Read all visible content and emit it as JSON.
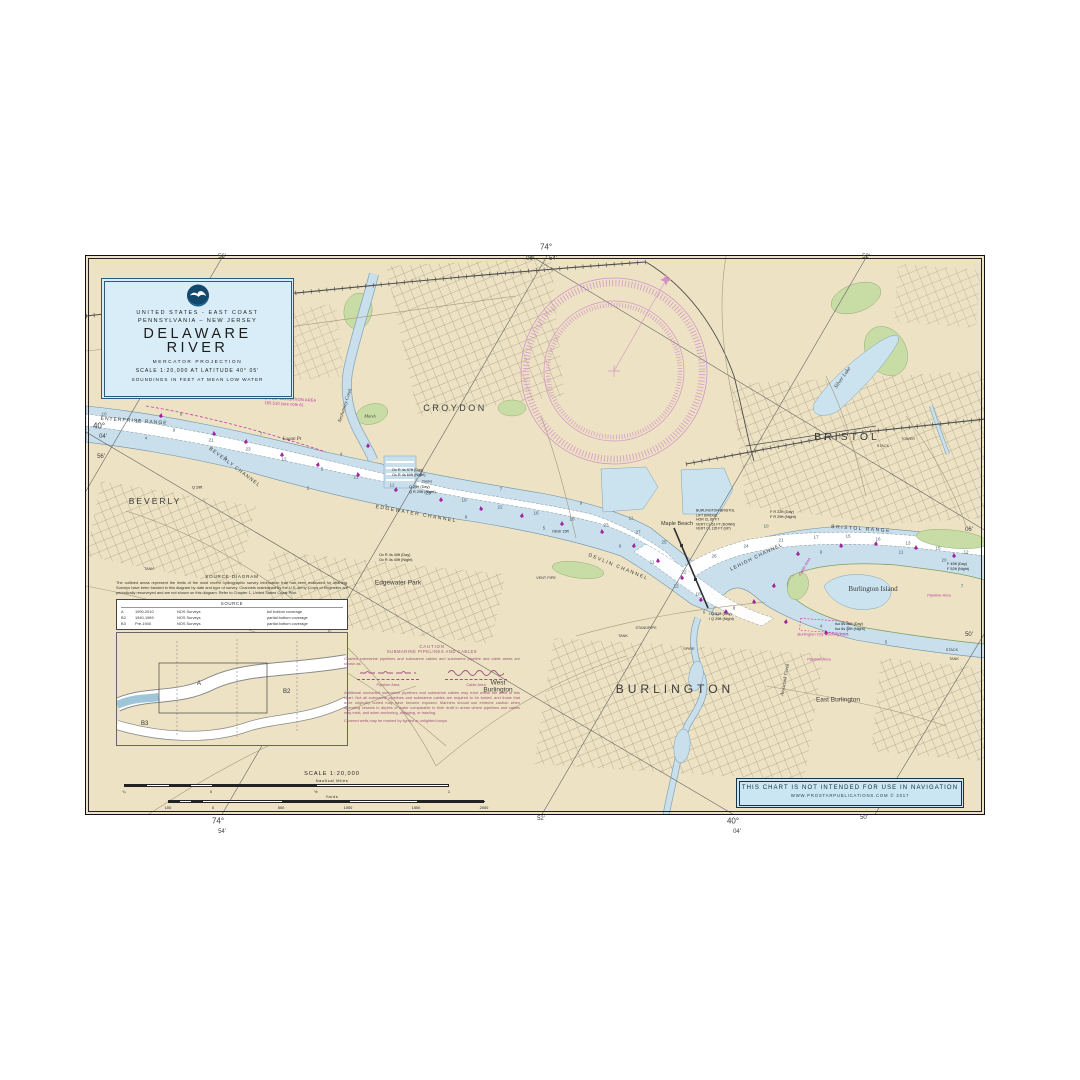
{
  "title_block": {
    "line1": "UNITED STATES - EAST COAST",
    "line2": "PENNSYLVANIA – NEW JERSEY",
    "title1": "DELAWARE",
    "title2": "RIVER",
    "line3": "MERCATOR PROJECTION",
    "line4": "SCALE 1:20,000 AT LATITUDE 40° 05'",
    "line5": "SOUNDINGS IN FEET AT MEAN LOW WATER"
  },
  "disclaimer": {
    "line1": "THIS CHART IS NOT INTENDED FOR USE IN NAVIGATION",
    "line2": "WWW.PROSTARPUBLICATIONS.COM   © 2017"
  },
  "source_diagram": {
    "heading": "SOURCE DIAGRAM",
    "body": "The outlined areas represent the limits of the most recent hydrographic survey information that has been evaluated for charting.  Surveys have been banded in this diagram by date and type of survey.  Channels maintained by the U.S. Army Corps of Engineers are periodically resurveyed and are not shown on this diagram.  Refer to Chapter 1, United States Coast Pilot.",
    "table_title": "SOURCE",
    "rows": [
      {
        "code": "A",
        "years": "1990-2010",
        "org": "NOS Surveys",
        "coverage": "full bottom coverage"
      },
      {
        "code": "B2",
        "years": "1940-1989",
        "org": "NOS Surveys",
        "coverage": "partial bottom coverage"
      },
      {
        "code": "B3",
        "years": "Pre-1940",
        "org": "NOS Surveys",
        "coverage": "partial bottom coverage"
      }
    ]
  },
  "caution": {
    "title": "CAUTION",
    "subtitle": "SUBMARINE PIPELINES AND CABLES",
    "para1": "Charted submarine pipelines and submarine cables and submarine pipeline and cable areas are shown as:",
    "pipeline_label": "Pipeline Area",
    "cable_label": "Cable Area",
    "para2": "Additional uncharted submarine pipelines and submarine cables may exist within the area of this chart.  Not all submarine pipelines and submarine cables are required to be buried, and those that were originally buried may have become exposed.  Mariners should use extreme caution when operating vessels in depths of water comparable to their draft in areas where pipelines and cables may exist, and when anchoring, dragging, or trawling.",
    "para3": "Covered wells may be marked by lighted or unlighted buoys."
  },
  "scalebar": {
    "title": "SCALE 1:20,000",
    "nm_label": "Nautical Miles",
    "yd_label": "Yards",
    "nm_ticks": [
      {
        "text": "¼",
        "x": 8,
        "ty": 18
      },
      {
        "text": "0",
        "x": 95,
        "ty": 18
      },
      {
        "text": "½",
        "x": 200,
        "ty": 18
      },
      {
        "text": "1",
        "x": 333,
        "ty": 18
      }
    ],
    "yd_ticks": [
      {
        "text": "100",
        "x": 52,
        "ty": 34
      },
      {
        "text": "0",
        "x": 97,
        "ty": 34
      },
      {
        "text": "500",
        "x": 165,
        "ty": 34
      },
      {
        "text": "1000",
        "x": 232,
        "ty": 34
      },
      {
        "text": "1500",
        "x": 300,
        "ty": 34
      },
      {
        "text": "2000",
        "x": 368,
        "ty": 34
      }
    ]
  },
  "chart": {
    "border_labels": [
      {
        "text": "56'",
        "x": 222,
        "y": 257,
        "size": 6
      },
      {
        "text": "74°",
        "x": 546,
        "y": 247,
        "size": 8
      },
      {
        "text": "06'",
        "x": 530,
        "y": 259,
        "size": 6
      },
      {
        "text": "54'",
        "x": 553,
        "y": 259,
        "size": 6
      },
      {
        "text": "52'",
        "x": 866,
        "y": 257,
        "size": 6
      },
      {
        "text": "40°",
        "x": 99,
        "y": 426,
        "size": 8
      },
      {
        "text": "04'",
        "x": 103,
        "y": 437,
        "size": 6
      },
      {
        "text": "56'",
        "x": 101,
        "y": 457,
        "size": 6
      },
      {
        "text": "06'",
        "x": 969,
        "y": 530,
        "size": 6
      },
      {
        "text": "50'",
        "x": 969,
        "y": 635,
        "size": 6
      },
      {
        "text": "74°",
        "x": 218,
        "y": 821,
        "size": 8
      },
      {
        "text": "54'",
        "x": 222,
        "y": 832,
        "size": 6
      },
      {
        "text": "52'",
        "x": 541,
        "y": 819,
        "size": 6
      },
      {
        "text": "40°",
        "x": 733,
        "y": 821,
        "size": 8
      },
      {
        "text": "04'",
        "x": 737,
        "y": 832,
        "size": 6
      },
      {
        "text": "50'",
        "x": 864,
        "y": 818,
        "size": 6
      }
    ],
    "labels": [
      {
        "text": "CROYDON",
        "x": 369,
        "y": 152,
        "size": 9,
        "ls": 2.5
      },
      {
        "text": "BRISTOL",
        "x": 761,
        "y": 181,
        "size": 10.5,
        "ls": 3
      },
      {
        "text": "BEVERLY",
        "x": 69,
        "y": 246,
        "size": 8.5,
        "ls": 2
      },
      {
        "text": "BURLINGTON",
        "x": 589,
        "y": 434,
        "size": 12,
        "ls": 4
      },
      {
        "text": "West\nBurlington",
        "x": 412,
        "y": 431,
        "size": 6.5
      },
      {
        "text": "East Burlington",
        "x": 752,
        "y": 444,
        "size": 6.5
      },
      {
        "text": "Edgewater Park",
        "x": 312,
        "y": 327,
        "size": 6.5
      },
      {
        "text": "Maple Beach",
        "x": 591,
        "y": 268,
        "size": 5.5
      },
      {
        "text": "Burlington  Island",
        "x": 787,
        "y": 333,
        "size": 7,
        "serif": true
      },
      {
        "text": "Silver Lake",
        "x": 757,
        "y": 122,
        "size": 5.5,
        "rot": -55,
        "serif": true,
        "italic": true
      },
      {
        "text": "Logan Pt",
        "x": 206,
        "y": 184,
        "size": 5,
        "serif": true,
        "italic": true
      },
      {
        "text": "Neshaminy Creek",
        "x": 260,
        "y": 150,
        "size": 5,
        "rot": -72,
        "serif": true,
        "italic": true
      },
      {
        "text": "Assiscunk Creek",
        "x": 700,
        "y": 424,
        "size": 5,
        "rot": -80,
        "serif": true,
        "italic": true
      },
      {
        "text": "Marsh",
        "x": 284,
        "y": 161,
        "size": 4.3,
        "serif": true,
        "italic": true
      },
      {
        "text": "ENTERPRISE RANGE",
        "x": 48,
        "y": 166,
        "size": 5,
        "ls": 1,
        "rot": 4
      },
      {
        "text": "BEVERLY CHANNEL",
        "x": 148,
        "y": 212,
        "size": 5,
        "ls": 1,
        "rot": 37
      },
      {
        "text": "EDGEWATER CHANNEL",
        "x": 330,
        "y": 259,
        "size": 5,
        "ls": 1.5,
        "rot": 10
      },
      {
        "text": "DEVLIN CHANNEL",
        "x": 532,
        "y": 312,
        "size": 5,
        "ls": 1.5,
        "rot": 22
      },
      {
        "text": "LEHIGH CHANNEL",
        "x": 671,
        "y": 302,
        "size": 5,
        "ls": 1,
        "rot": -26
      },
      {
        "text": "BRISTOL RANGE",
        "x": 775,
        "y": 274,
        "size": 5,
        "ls": 1.5,
        "rot": 4
      },
      {
        "text": "REGULATED NAVIGATION AREA\n165.510 (see note A)",
        "x": 198,
        "y": 146,
        "size": 4.2,
        "color": "#C13AA4",
        "rot": 3
      },
      {
        "text": "Burlington City Mooring Area",
        "x": 737,
        "y": 379,
        "size": 4,
        "color": "#C13AA4"
      },
      {
        "text": "Pipeline Area",
        "x": 733,
        "y": 404,
        "size": 4,
        "color": "#C13AA4",
        "italic": true
      },
      {
        "text": "Cable Area",
        "x": 719,
        "y": 311,
        "size": 4,
        "color": "#C13AA4",
        "italic": true,
        "rot": -60
      },
      {
        "text": "Pipeline Area",
        "x": 853,
        "y": 340,
        "size": 4,
        "color": "#C13AA4",
        "italic": true
      },
      {
        "text": "TANK",
        "x": 63,
        "y": 313,
        "size": 3.8
      },
      {
        "text": "Tanks",
        "x": 341,
        "y": 226,
        "size": 4
      },
      {
        "text": "TOWER",
        "x": 822,
        "y": 183,
        "size": 3.8
      },
      {
        "text": "STACK",
        "x": 797,
        "y": 190,
        "size": 3.8
      },
      {
        "text": "SPIRE",
        "x": 603,
        "y": 393,
        "size": 3.8
      },
      {
        "text": "TANK",
        "x": 537,
        "y": 380,
        "size": 3.8
      },
      {
        "text": "STANDPIPE",
        "x": 560,
        "y": 372,
        "size": 3.8
      },
      {
        "text": "VENT PIPE",
        "x": 460,
        "y": 322,
        "size": 3.8
      },
      {
        "text": "STACK",
        "x": 866,
        "y": 394,
        "size": 3.8
      },
      {
        "text": "TANK",
        "x": 868,
        "y": 403,
        "size": 3.8
      }
    ],
    "lights": [
      {
        "text": "Oc R 4s 57ft (Day)\nOc R 4s 60ft (Night)",
        "x": 306,
        "y": 217
      },
      {
        "text": "Q 29ft (Day)\nQ R 29ft (Night)",
        "x": 323,
        "y": 234
      },
      {
        "text": "F R 22ft (Day)\nF R 29ft (Night)",
        "x": 684,
        "y": 259
      },
      {
        "text": "F 45ft (Day)\nF 52ft (Night)",
        "x": 861,
        "y": 311
      },
      {
        "text": "Oc R 4s 40ft (Day)\nOc R 4s 40ft (Night)",
        "x": 293,
        "y": 302
      },
      {
        "text": "BURLINGTON-BRISTOL\nLIFT BRIDGE\nHOR CL 60 FT\nVERT CL 61 FT (DOWN)\nVERT CL 135 FT (UP)",
        "x": 610,
        "y": 264,
        "size": 3.5
      },
      {
        "text": "Iso 6s 25ft (Day)\nIso 6s 28ft (Night)",
        "x": 749,
        "y": 371
      },
      {
        "text": "I Q 31ft (Day)\nI Q 29ft (Night)",
        "x": 623,
        "y": 361
      },
      {
        "text": "Obstr 15ft",
        "x": 466,
        "y": 276
      },
      {
        "text": "Q 29ft",
        "x": 106,
        "y": 232
      }
    ],
    "depths": [
      {
        "text": "10",
        "x": 18,
        "y": 158
      },
      {
        "text": "12",
        "x": 52,
        "y": 165
      },
      {
        "text": "9",
        "x": 88,
        "y": 174
      },
      {
        "text": "21",
        "x": 125,
        "y": 184
      },
      {
        "text": "23",
        "x": 162,
        "y": 193
      },
      {
        "text": "12",
        "x": 198,
        "y": 203
      },
      {
        "text": "5",
        "x": 236,
        "y": 213
      },
      {
        "text": "21",
        "x": 270,
        "y": 221
      },
      {
        "text": "12",
        "x": 306,
        "y": 229
      },
      {
        "text": "23",
        "x": 342,
        "y": 237
      },
      {
        "text": "19",
        "x": 378,
        "y": 244
      },
      {
        "text": "22",
        "x": 414,
        "y": 251
      },
      {
        "text": "16",
        "x": 450,
        "y": 257
      },
      {
        "text": "18",
        "x": 486,
        "y": 263
      },
      {
        "text": "23",
        "x": 520,
        "y": 269
      },
      {
        "text": "27",
        "x": 552,
        "y": 276
      },
      {
        "text": "25",
        "x": 578,
        "y": 286
      },
      {
        "text": "22",
        "x": 598,
        "y": 316
      },
      {
        "text": "26",
        "x": 628,
        "y": 300
      },
      {
        "text": "24",
        "x": 660,
        "y": 290
      },
      {
        "text": "21",
        "x": 695,
        "y": 284
      },
      {
        "text": "17",
        "x": 730,
        "y": 281
      },
      {
        "text": "15",
        "x": 762,
        "y": 280
      },
      {
        "text": "16",
        "x": 792,
        "y": 283
      },
      {
        "text": "13",
        "x": 822,
        "y": 287
      },
      {
        "text": "15",
        "x": 852,
        "y": 292
      },
      {
        "text": "12",
        "x": 880,
        "y": 296
      },
      {
        "text": "4",
        "x": 60,
        "y": 182
      },
      {
        "text": "3",
        "x": 140,
        "y": 202
      },
      {
        "text": "2",
        "x": 222,
        "y": 232
      },
      {
        "text": "7",
        "x": 300,
        "y": 250
      },
      {
        "text": "8",
        "x": 380,
        "y": 261
      },
      {
        "text": "5",
        "x": 458,
        "y": 272
      },
      {
        "text": "9",
        "x": 534,
        "y": 290
      },
      {
        "text": "11",
        "x": 566,
        "y": 306
      },
      {
        "text": "10",
        "x": 612,
        "y": 338
      },
      {
        "text": "8",
        "x": 648,
        "y": 352
      },
      {
        "text": "6",
        "x": 95,
        "y": 158
      },
      {
        "text": "7",
        "x": 175,
        "y": 178
      },
      {
        "text": "4",
        "x": 255,
        "y": 198
      },
      {
        "text": "8",
        "x": 335,
        "y": 218
      },
      {
        "text": "7",
        "x": 415,
        "y": 233
      },
      {
        "text": "9",
        "x": 495,
        "y": 247
      },
      {
        "text": "11",
        "x": 545,
        "y": 262
      },
      {
        "text": "10",
        "x": 680,
        "y": 270
      },
      {
        "text": "9",
        "x": 735,
        "y": 296
      },
      {
        "text": "11",
        "x": 815,
        "y": 296
      },
      {
        "text": "20",
        "x": 858,
        "y": 304
      },
      {
        "text": "7",
        "x": 876,
        "y": 330
      },
      {
        "text": "5",
        "x": 800,
        "y": 386
      },
      {
        "text": "4",
        "x": 735,
        "y": 370
      },
      {
        "text": "6",
        "x": 618,
        "y": 356
      },
      {
        "text": "12",
        "x": 590,
        "y": 330
      }
    ],
    "buoys": [
      {
        "x": 75,
        "y": 160,
        "rot": 10
      },
      {
        "x": 128,
        "y": 178,
        "rot": -8
      },
      {
        "x": 160,
        "y": 186,
        "rot": 12
      },
      {
        "x": 196,
        "y": 199,
        "rot": 0
      },
      {
        "x": 232,
        "y": 209,
        "rot": 15
      },
      {
        "x": 272,
        "y": 219,
        "rot": -10
      },
      {
        "x": 310,
        "y": 234,
        "rot": 8
      },
      {
        "x": 355,
        "y": 244,
        "rot": 0
      },
      {
        "x": 395,
        "y": 253,
        "rot": -12
      },
      {
        "x": 436,
        "y": 260,
        "rot": 10
      },
      {
        "x": 476,
        "y": 268,
        "rot": 0
      },
      {
        "x": 516,
        "y": 276,
        "rot": -8
      },
      {
        "x": 548,
        "y": 290,
        "rot": 12
      },
      {
        "x": 572,
        "y": 305,
        "rot": 0
      },
      {
        "x": 596,
        "y": 322,
        "rot": -10
      },
      {
        "x": 615,
        "y": 344,
        "rot": 8
      },
      {
        "x": 640,
        "y": 356,
        "rot": 0
      },
      {
        "x": 668,
        "y": 346,
        "rot": -8
      },
      {
        "x": 688,
        "y": 330,
        "rot": 10
      },
      {
        "x": 712,
        "y": 298,
        "rot": 0
      },
      {
        "x": 755,
        "y": 290,
        "rot": -10
      },
      {
        "x": 790,
        "y": 288,
        "rot": 8
      },
      {
        "x": 830,
        "y": 292,
        "rot": 0
      },
      {
        "x": 868,
        "y": 300,
        "rot": -6
      },
      {
        "x": 700,
        "y": 366,
        "rot": 10
      },
      {
        "x": 740,
        "y": 377,
        "rot": -8
      },
      {
        "x": 282,
        "y": 190,
        "rot": 0
      }
    ]
  }
}
